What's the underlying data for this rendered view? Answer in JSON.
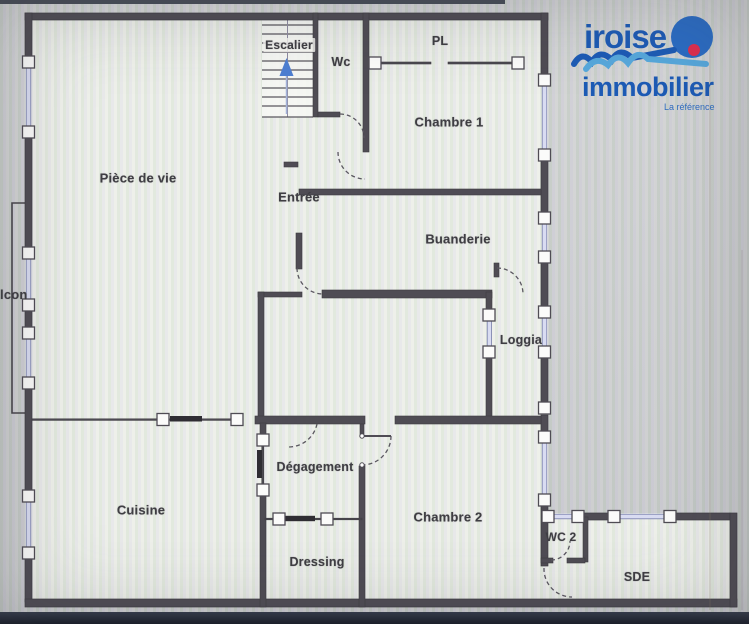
{
  "logo": {
    "line1": "iroise",
    "line2": "immobilier",
    "tagline": "La référence",
    "brand_blue": "#1d5bb5",
    "light_blue": "#57a8dc",
    "dot_red": "#e02e4f"
  },
  "rooms": [
    {
      "id": "escalier",
      "label": "Escalier"
    },
    {
      "id": "wc",
      "label": "Wc"
    },
    {
      "id": "pl",
      "label": "PL"
    },
    {
      "id": "chambre-1",
      "label": "Chambre 1"
    },
    {
      "id": "piece-de-vie",
      "label": "Pièce de vie"
    },
    {
      "id": "entree",
      "label": "Entrée"
    },
    {
      "id": "buanderie",
      "label": "Buanderie"
    },
    {
      "id": "balcon",
      "label": "Balcon"
    },
    {
      "id": "loggia",
      "label": "Loggia"
    },
    {
      "id": "degagement",
      "label": "Dégagement"
    },
    {
      "id": "cuisine",
      "label": "Cuisine"
    },
    {
      "id": "dressing",
      "label": "Dressing"
    },
    {
      "id": "chambre-2",
      "label": "Chambre 2"
    },
    {
      "id": "wc-2",
      "label": "WC 2"
    },
    {
      "id": "sde",
      "label": "SDE"
    }
  ]
}
